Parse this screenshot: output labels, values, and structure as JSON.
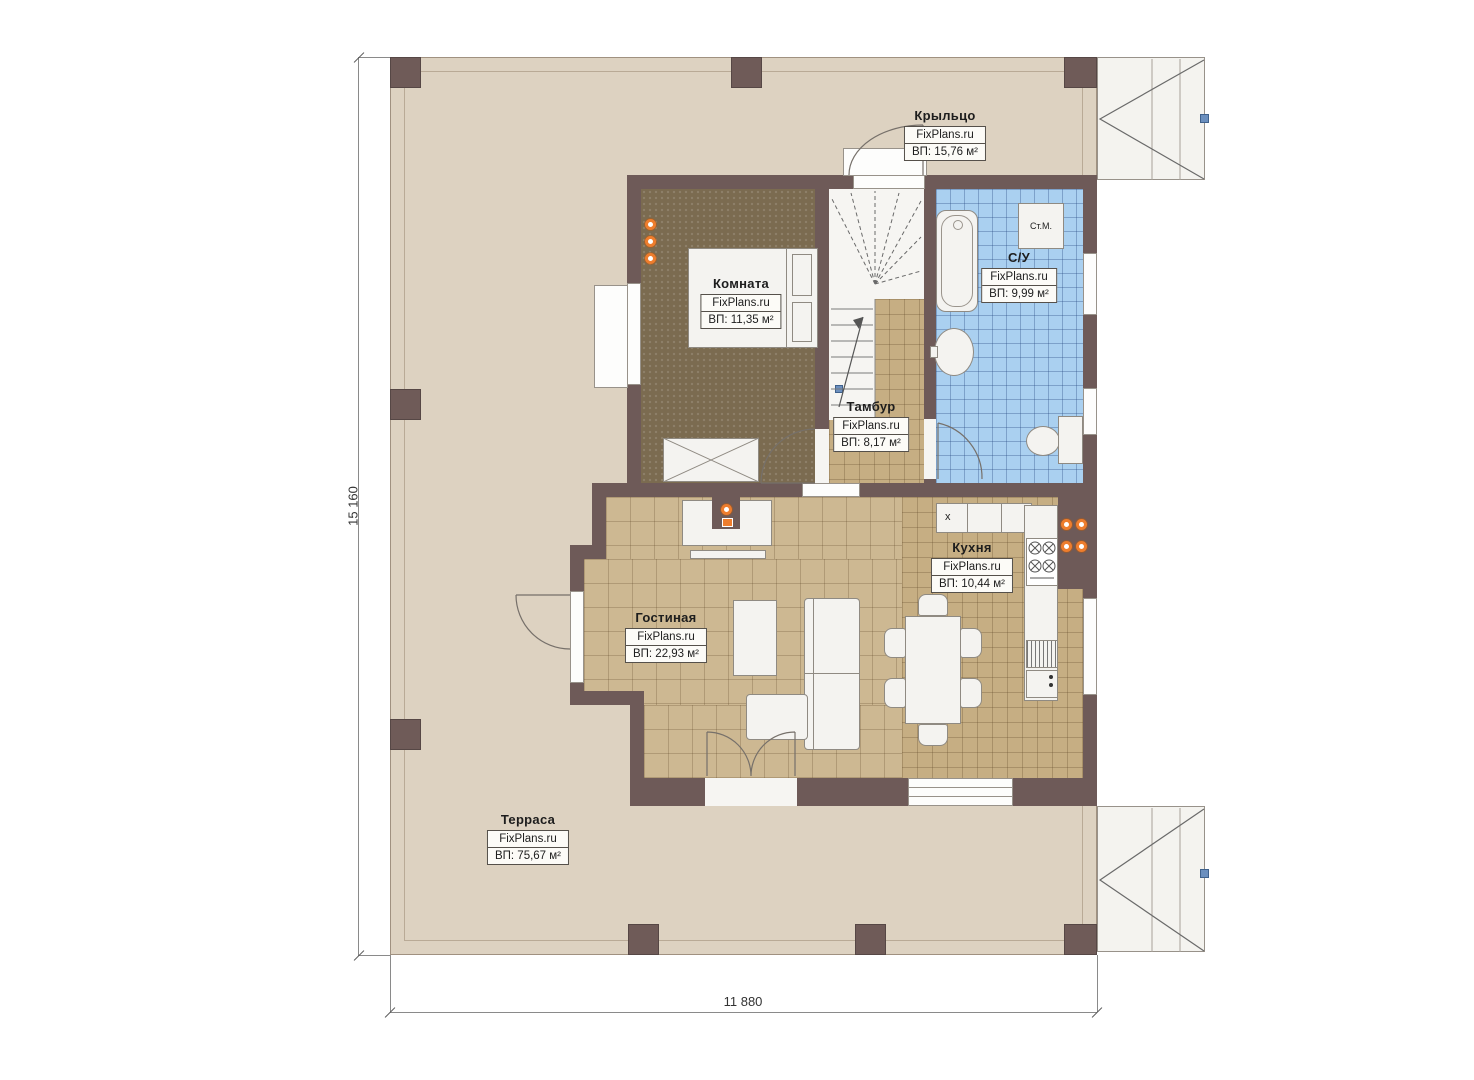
{
  "site_label": "FixPlans.ru",
  "dimensions": {
    "height_label": "15 160",
    "width_label": "11 880"
  },
  "rooms": [
    {
      "name": "Крыльцо",
      "area": "ВП: 15,76 м²"
    },
    {
      "name": "Комната",
      "area": "ВП: 11,35 м²"
    },
    {
      "name": "С/У",
      "area": "ВП: 9,99 м²"
    },
    {
      "name": "Тамбур",
      "area": "ВП: 8,17 м²"
    },
    {
      "name": "Кухня",
      "area": "ВП: 10,44 м²"
    },
    {
      "name": "Гостиная",
      "area": "ВП: 22,93 м²"
    },
    {
      "name": "Терраса",
      "area": "ВП: 75,67 м²"
    }
  ],
  "annotations": {
    "washing_machine": "Ст.М.",
    "kitchen_marker": "x"
  },
  "colors": {
    "wall": "#6e5a58",
    "terrace_floor": "#ddd2c1",
    "bedroom_carpet": "#7b6b50",
    "tile_floor": "#c8b289",
    "bathroom_tile": "#aad0f0",
    "accent_orange": "#ee7d2d"
  }
}
